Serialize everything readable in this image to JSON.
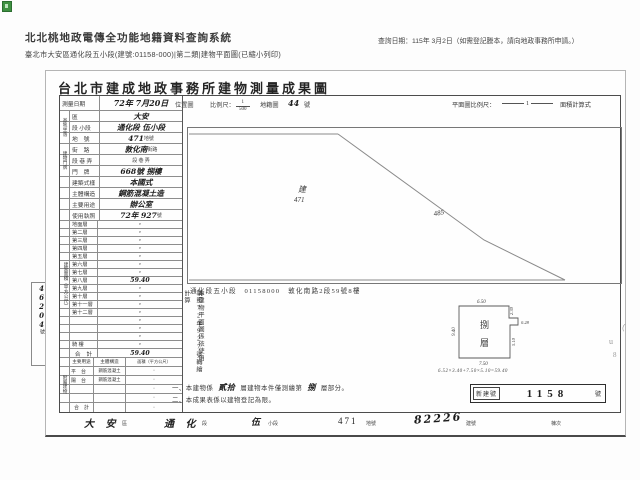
{
  "page": {
    "system_title": "北北桃地政電傳全功能地籍資料查詢系統",
    "query_date": "查詢日期：115年 3月2日（如需登記謄本，請向地政事務所申請。）",
    "subtitle": "臺北市大安區通化段五小段(建號:01158-000)|第二類|建物平面圖(已縮小列印)"
  },
  "document": {
    "title": "台北市建成地政事務所建物測量成果圖",
    "survey_date": {
      "label": "測量日期",
      "value": "72年 7月20日"
    },
    "form_header": {
      "map_label": "位置圖",
      "scale_label": "比例尺：",
      "scale_num": "1",
      "scale_den": "500",
      "grid_label": "地籍圖",
      "grid_no": "44",
      "grid_unit": "號",
      "plan_scale_label": "平面圖比例尺：",
      "plan_scale_value": "1",
      "area_calc_label": "面積計算式"
    },
    "site_group_label": "基地坐落",
    "address_group_label": "建物門牌",
    "info_rows": [
      {
        "label": "區",
        "value": "大安",
        "unit": ""
      },
      {
        "label": "段 小段",
        "value": "通化段 伍小段",
        "unit": ""
      },
      {
        "label": "地　號",
        "value": "471",
        "unit": "地號"
      },
      {
        "label": "街　路",
        "value": "敦化南",
        "unit": "街路"
      },
      {
        "label": "段 巷 弄",
        "value": "",
        "unit": "段 巷 弄"
      },
      {
        "label": "門　牌",
        "value": "668號 捌樓",
        "unit": ""
      },
      {
        "label": "建築式樣",
        "value": "本國式",
        "unit": ""
      },
      {
        "label": "主體構造",
        "value": "鋼筋混凝土造",
        "unit": ""
      },
      {
        "label": "主要用途",
        "value": "辦公室",
        "unit": ""
      },
      {
        "label": "使用執照",
        "value": "72年 927",
        "unit": "號"
      }
    ],
    "floor_area": {
      "group_label": "建築面積（平方公尺）",
      "rows": [
        {
          "label": "地面層",
          "value": "·"
        },
        {
          "label": "第二層",
          "value": "·"
        },
        {
          "label": "第三層",
          "value": "·"
        },
        {
          "label": "第四層",
          "value": "·"
        },
        {
          "label": "第五層",
          "value": "·"
        },
        {
          "label": "第六層",
          "value": "·"
        },
        {
          "label": "第七層",
          "value": "·"
        },
        {
          "label": "第八層",
          "value": "59.40"
        },
        {
          "label": "第九層",
          "value": "·"
        },
        {
          "label": "第十層",
          "value": "·"
        },
        {
          "label": "第十一層",
          "value": "·"
        },
        {
          "label": "第十二層",
          "value": "·"
        },
        {
          "label": "",
          "value": "·"
        },
        {
          "label": "",
          "value": "·"
        },
        {
          "label": "",
          "value": "·"
        },
        {
          "label": "騎 樓",
          "value": "·"
        }
      ],
      "total_label": "合　計",
      "total_value": "59.40"
    },
    "annex": {
      "group_label": "附屬建物",
      "header_use": "主要用途",
      "header_structure": "主體構造",
      "header_area": "面積（平方公尺）",
      "rows": [
        {
          "use": "平　台",
          "structure": "鋼筋混凝土",
          "area": "·"
        },
        {
          "use": "陽　台",
          "structure": "鋼筋混凝土",
          "area": "·"
        },
        {
          "use": "",
          "structure": "",
          "area": "·"
        },
        {
          "use": "",
          "structure": "",
          "area": "·"
        }
      ],
      "total_label": "合　計",
      "total_area": "·"
    },
    "application_strip": {
      "printed": "申請書（72）建北二字第",
      "hand_no": "46204",
      "suffix": "號"
    },
    "location_map": {
      "parcel_label": "建",
      "parcel_no": "471",
      "adjacent_no": "485",
      "caption": "通化段五小段　01158000　敦化南路2段59號8樓"
    },
    "plan_note_col_right": "本建物平面圖係依使用",
    "plan_note_col_left": "執照72年927號轉繪計算",
    "floor_plan": {
      "floor_chars": [
        "捌",
        "層"
      ],
      "dims": {
        "top": "6.50",
        "left": "9.40",
        "right_upper": "2.30",
        "right_tab": "0.28",
        "right_lower": "5.10",
        "bottom": "7.50"
      },
      "formula": "6.52×3.40+7.50×5.10=59.40"
    },
    "new_building_no": {
      "label": "新建號",
      "value": "1158",
      "unit": "號"
    },
    "notes": {
      "n1_prefix": "一、本建物係",
      "n1_hand1": "貳拾",
      "n1_mid": "層建物本件僅測繪第",
      "n1_hand2": "捌",
      "n1_suffix": "層部分。",
      "n2": "二、本成果表係以建物登記為限。"
    },
    "footer": {
      "district": "大 安",
      "district_unit": "區",
      "section": "通 化",
      "section_unit": "段",
      "subsection": "伍",
      "subsection_unit": "小段",
      "parcel": "471",
      "parcel_unit": "地號",
      "building_no": "82226",
      "building_unit": "建號",
      "unit_label": "棟次"
    },
    "margin_marks": [
      "（",
      "u",
      "8"
    ]
  }
}
